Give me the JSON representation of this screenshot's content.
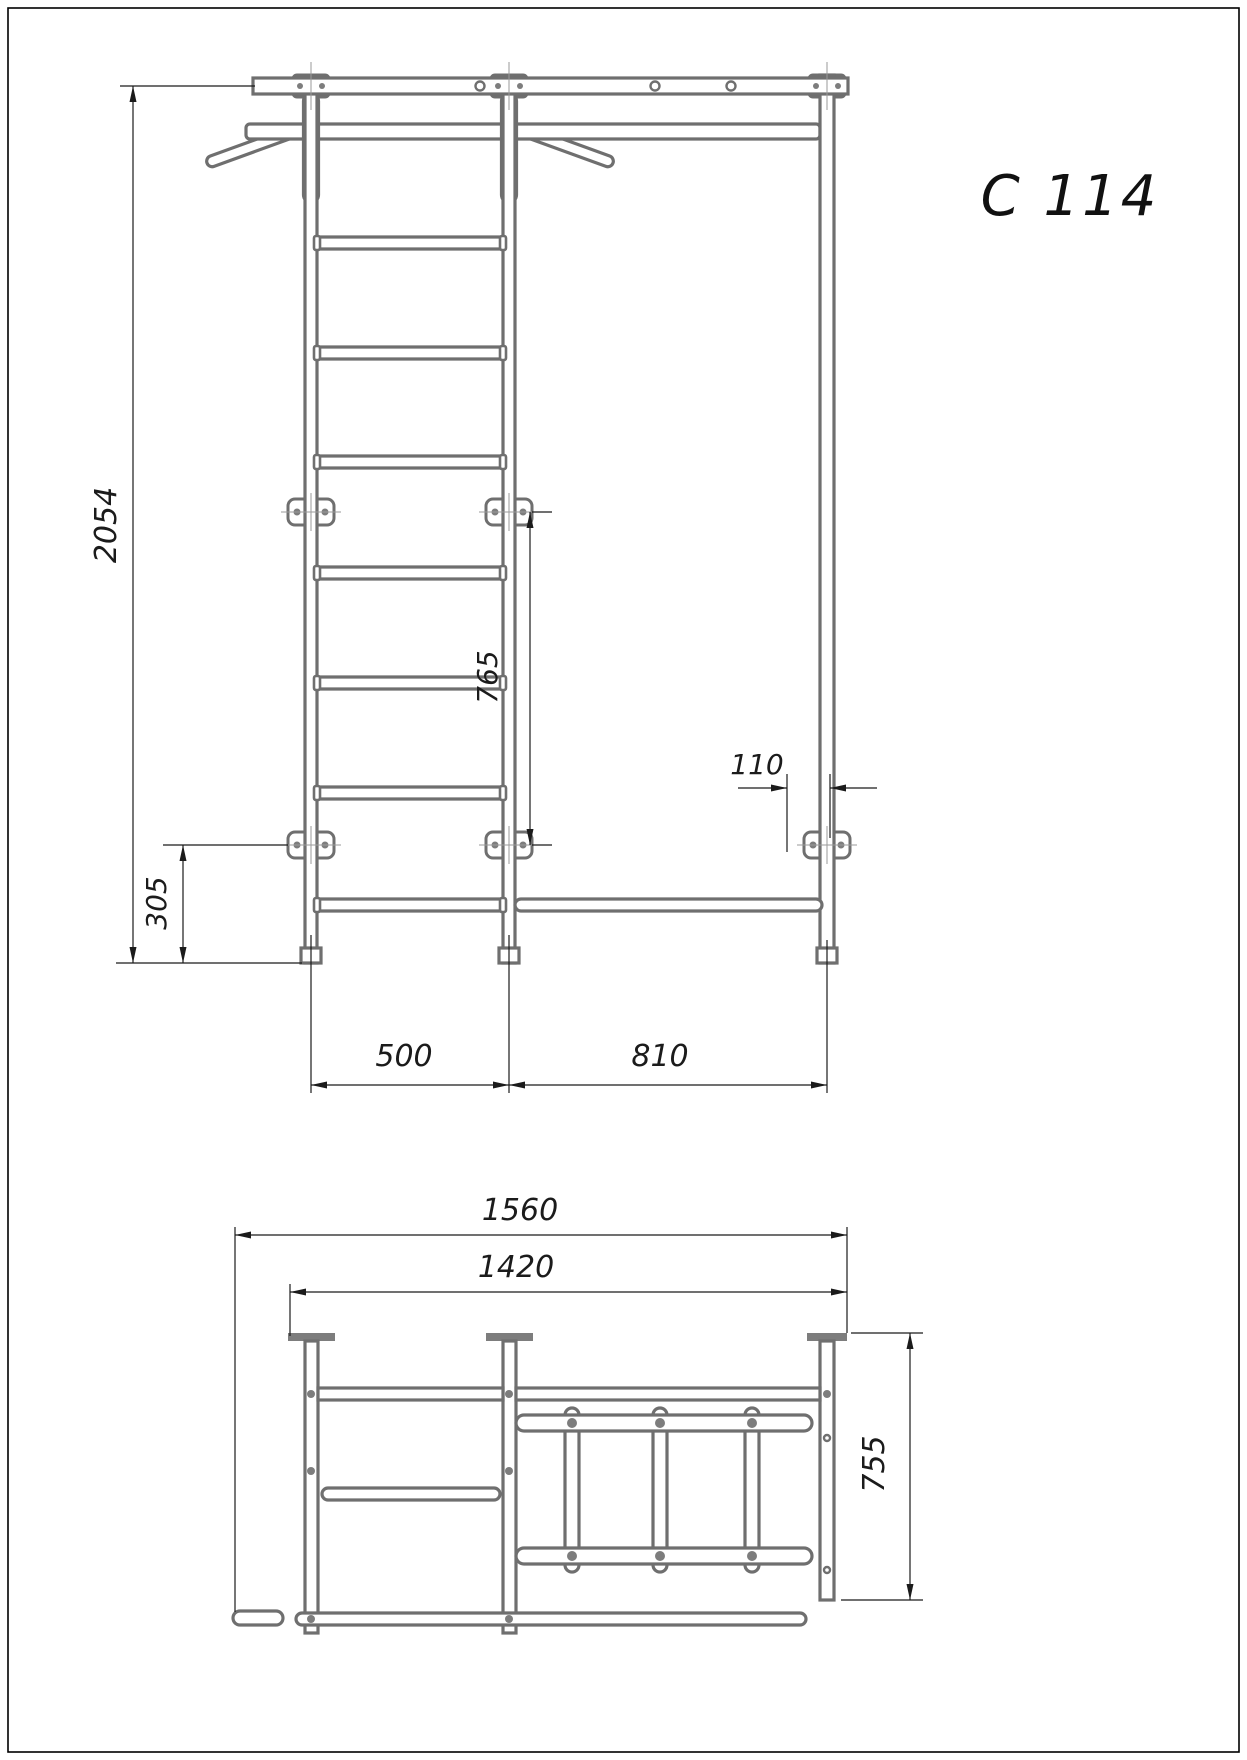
{
  "title": "C 114",
  "drawing_type": "technical drawing - wall bars / gymnastics ladder",
  "style": {
    "structure_color": "#6f6f6f",
    "dimension_color": "#1b1b1b",
    "background": "#ffffff"
  },
  "front_view": {
    "label": "front elevation",
    "dims": {
      "total_height": "2054",
      "bracket_span": "765",
      "wall_offset": "110",
      "lower_bracket_height": "305",
      "ladder_width": "500",
      "extension_width": "810"
    }
  },
  "plan_view": {
    "label": "top view",
    "dims": {
      "overall_width": "1560",
      "frame_width": "1420",
      "depth": "755"
    }
  }
}
